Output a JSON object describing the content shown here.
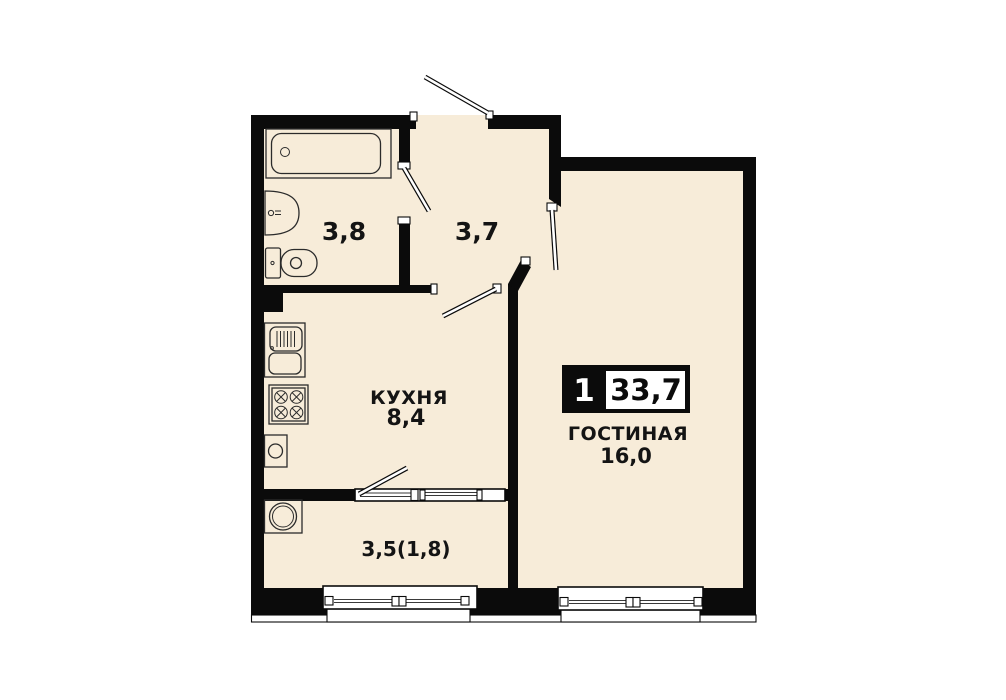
{
  "floor_plan": {
    "summary_badge": {
      "room_count": "1",
      "total_area": "33,7"
    },
    "rooms": {
      "bathroom": {
        "area": "3,8"
      },
      "hallway": {
        "area": "3,7"
      },
      "kitchen": {
        "name": "КУХНЯ",
        "area": "8,4"
      },
      "living_room": {
        "name": "ГОСТИНАЯ",
        "area": "16,0"
      },
      "balcony": {
        "area": "3,5(1,8)"
      }
    },
    "colors": {
      "floor": "#f7ecd9",
      "walls": "#0b0b0b",
      "background": "#ffffff"
    }
  }
}
